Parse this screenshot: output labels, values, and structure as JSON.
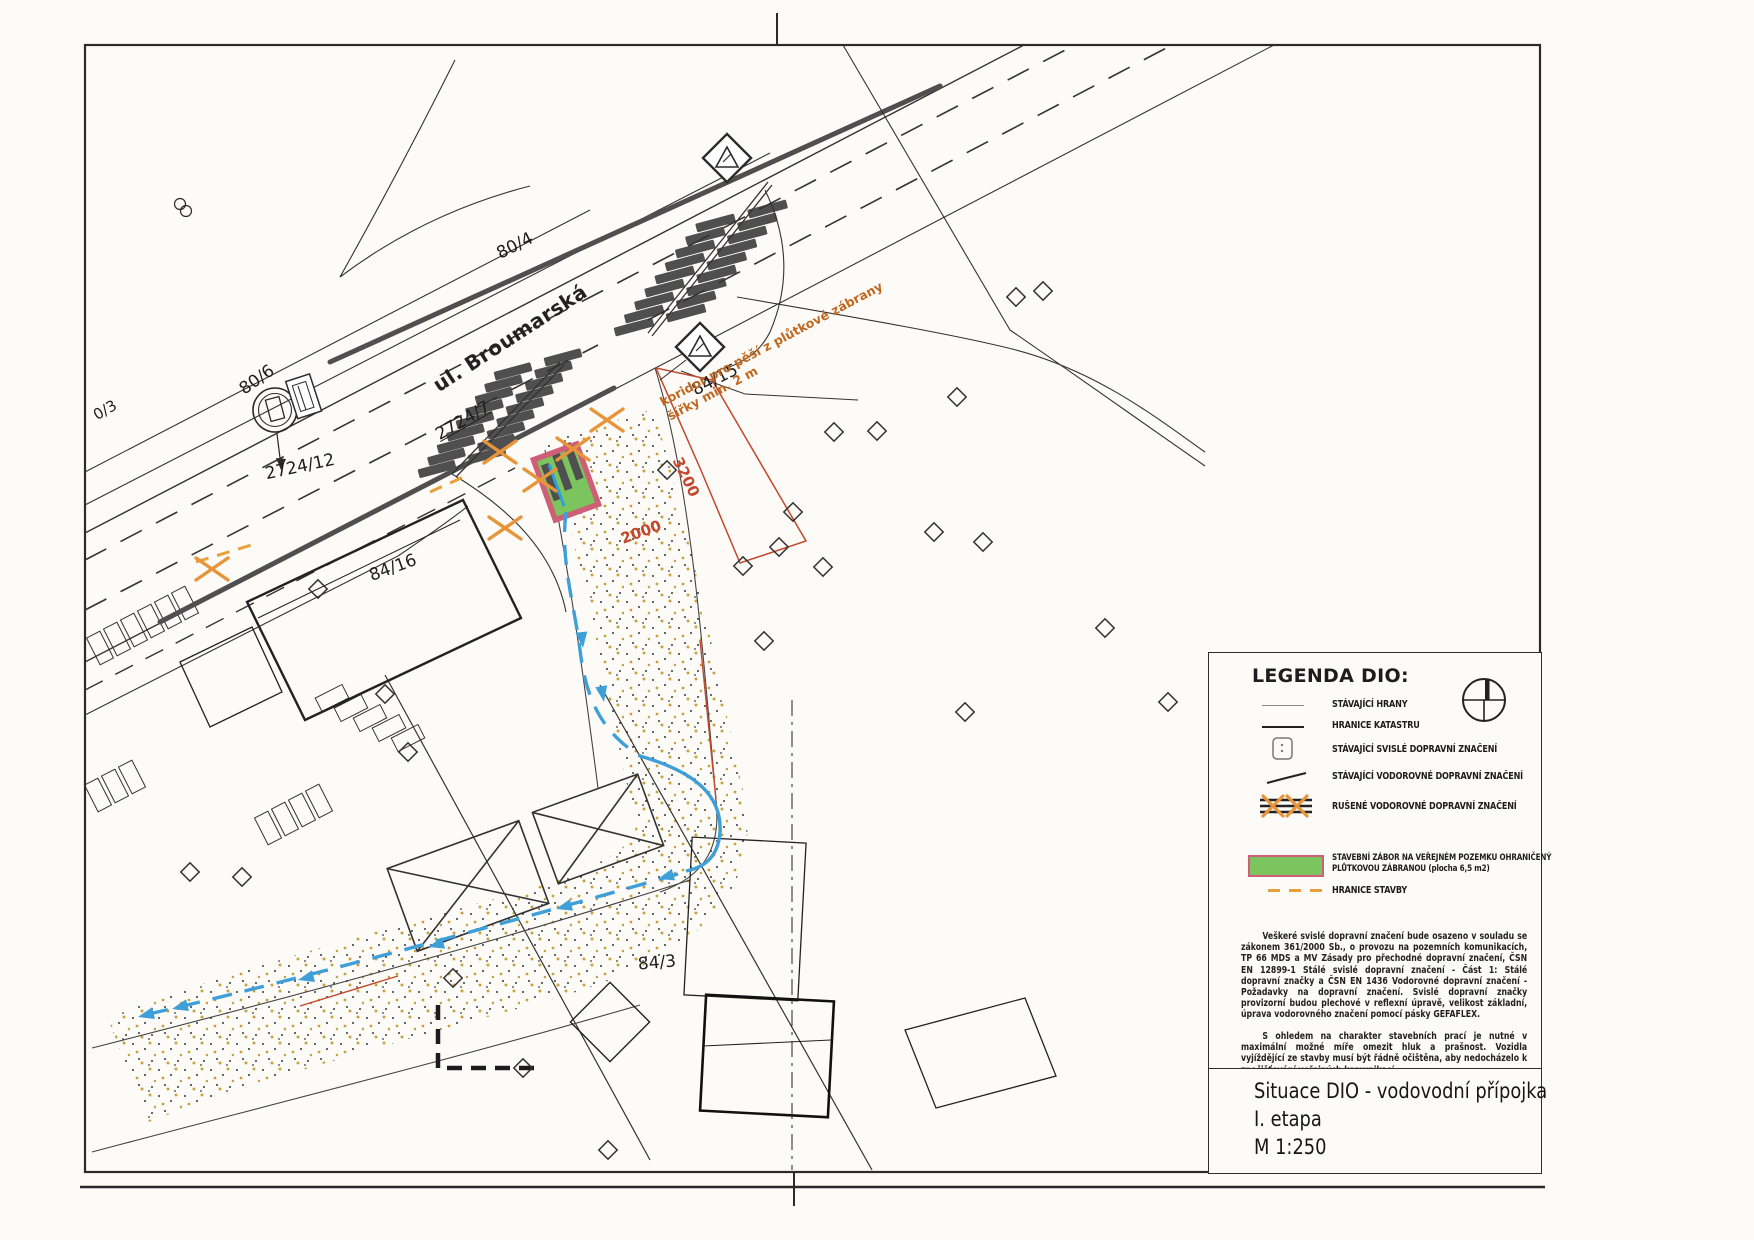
{
  "map": {
    "street": "ul. Broumarská",
    "parcel_labels": [
      "80/4",
      "80/6",
      "0/3",
      "2724/12",
      "2724/7",
      "84/15",
      "84/16",
      "84/3"
    ],
    "koridor_note": {
      "line1": "koridor pro pěší z plůtkové zábrany",
      "line2": "šířky min. 2 m"
    },
    "dimensions": {
      "dim1": "3200",
      "dim2": "2000"
    }
  },
  "legend": {
    "title": "LEGENDA DIO:",
    "items": [
      {
        "symbol": "thin-line",
        "label": "STÁVAJÍCÍ HRANY"
      },
      {
        "symbol": "solid-line",
        "label": "HRANICE KATASTRU"
      },
      {
        "symbol": "traffic-sign-square",
        "label": "STÁVAJÍCÍ SVISLÉ DOPRAVNÍ ZNAČENÍ"
      },
      {
        "symbol": "short-slanted-line",
        "label": "STÁVAJÍCÍ VODOROVNÉ DOPRAVNÍ ZNAČENÍ"
      },
      {
        "symbol": "crossed-orange-lines",
        "label": "RUŠENÉ VODOROVNÉ DOPRAVNÍ ZNAČENÍ"
      },
      {
        "symbol": "green-rect",
        "label": "STAVEBNÍ ZÁBOR NA VEŘEJNÉM POZEMKU OHRANIČENÝ PLŮTKOVOU ZÁBRANOU (plocha 6,5 m2)"
      },
      {
        "symbol": "orange-dashes",
        "label": "HRANICE STAVBY"
      }
    ],
    "paragraph1": "Veškeré svislé dopravní značení bude osazeno v souladu se zákonem 361/2000 Sb., o provozu na pozemních komunikacích, TP 66 MDS a MV Zásady pro přechodné dopravní značení, ČSN EN 12899-1 Stálé svislé dopravní značení - Část 1: Stálé dopravní značky a ČSN EN 1436 Vodorovné dopravní značení - Požadavky na dopravní značení. Svislé dopravní značky provizorní budou plechové v reflexní úpravě, velikost základní, úprava vodorovného značení pomocí pásky GEFAFLEX.",
    "paragraph2": "S ohledem na charakter stavebních prací je nutné v maximální možné míře omezit hluk a prašnost. Vozidla vyjíždějící ze stavby musí být řádně očištěna, aby nedocházelo k znečišťování veřejných komunikací."
  },
  "title_block": {
    "line1": "Situace DIO - vodovodní přípojka",
    "line2": "I. etapa",
    "line3": "M 1:250"
  },
  "colors": {
    "line_dark": "#2e2e2e",
    "road_gray": "#4f4f4f",
    "orange_marking": "#e8953a",
    "orange_boundary": "#e8a13a",
    "red_orange_dim": "#c2472b",
    "blue_route": "#3f9fd8",
    "zabor_green": "#7cc45e",
    "zabor_pink": "#cf5f76",
    "koridor_text": "#c06820"
  }
}
